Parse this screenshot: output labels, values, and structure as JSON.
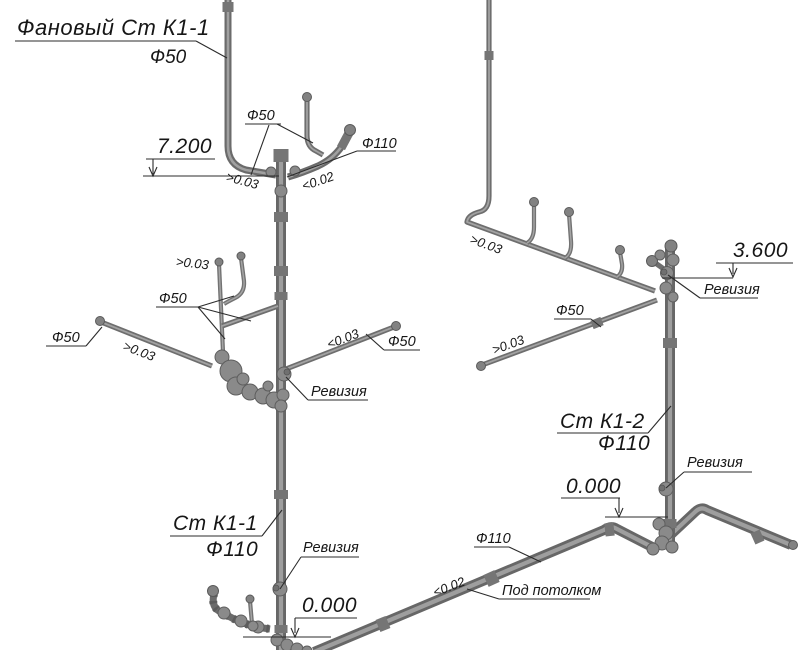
{
  "drawing": {
    "background": "#ffffff",
    "pipe_color": "#6e6e6e",
    "pipe_highlight": "#9e9e9e",
    "line_color": "#2b2b2b",
    "text_color": "#161616",
    "vent_stack": {
      "name": "Фановый Ст К1-1",
      "diameter": "Ф50"
    },
    "stack_k1_1": {
      "name": "Ст К1-1",
      "diameter": "Ф110"
    },
    "stack_k1_2": {
      "name": "Ст К1-2",
      "diameter": "Ф110"
    },
    "elevations": {
      "vent_top": "7.200",
      "branch_right": "3.600",
      "floor": "0.000"
    },
    "slopes": {
      "min_003": ">0.03",
      "max_002": "<0.02",
      "max_003": "<0.03"
    },
    "diameters": {
      "d50": "Ф50",
      "d110": "Ф110"
    },
    "fittings": {
      "revision": "Ревизия"
    },
    "notes": {
      "under_ceiling": "Под потолком"
    }
  }
}
